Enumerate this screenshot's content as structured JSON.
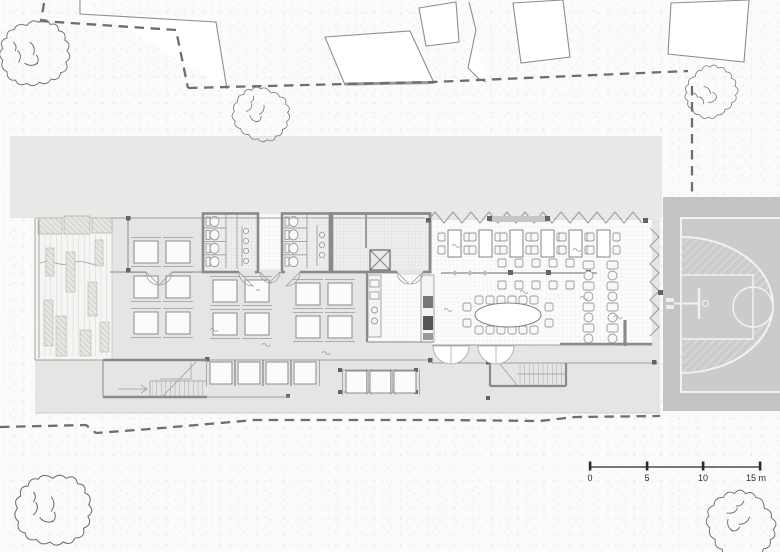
{
  "scale_bar": {
    "unit_labels": [
      "0",
      "5",
      "10",
      "15 m"
    ]
  },
  "colors": {
    "paper": "#fbfbfa",
    "roof": "#e8e8e7",
    "slab": "#e5e5e4",
    "court": "#c3c3c2",
    "court-floor": "#cbcbca",
    "court-line": "#f2f2f0",
    "wall": "#8a8a8a",
    "line": "#9e9e9c",
    "boundary": "#6e6e6e",
    "furniture": "#ffffff",
    "ink": "#2b2b2b"
  }
}
